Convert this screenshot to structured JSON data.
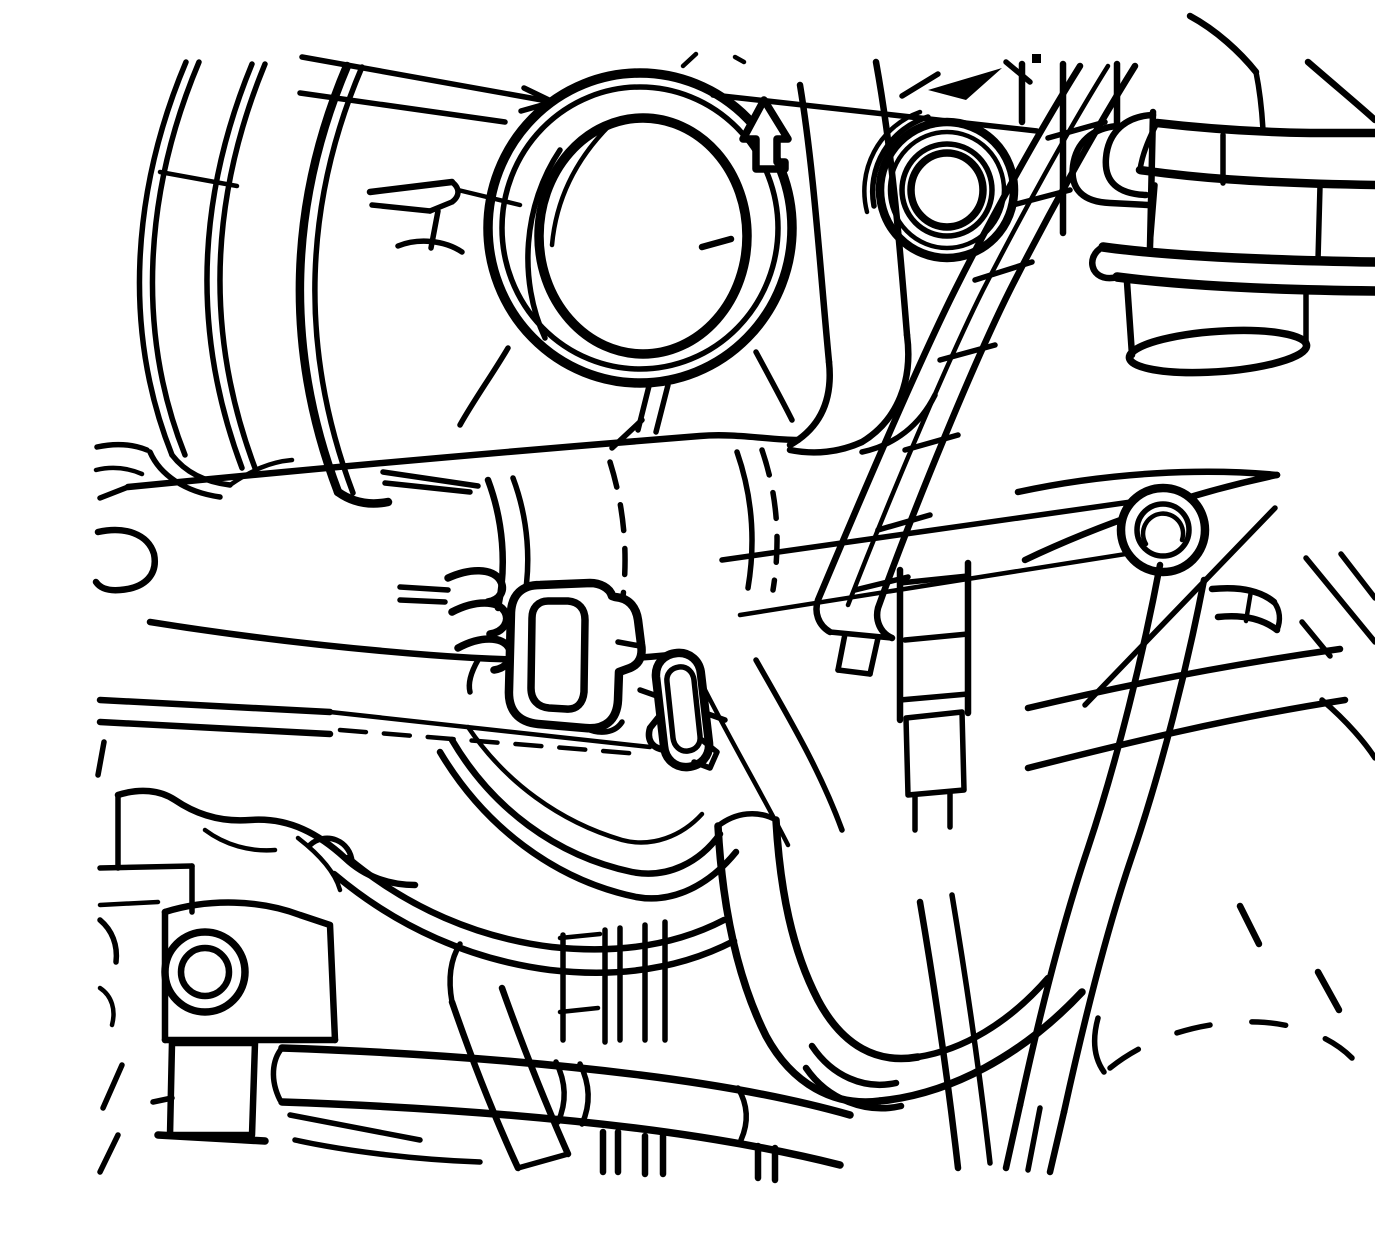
{
  "meta": {
    "title": "Engine compartment line illustration",
    "description": "Black-and-white service-manual line drawing of an engine viewed from the front-lower side, showing the air intake duct opening, hoses, wiring harness conduit and an electrical connector, with an upward-pointing arrow indicator beside the intake opening.",
    "background_color": "#ffffff",
    "ink_color": "#000000"
  },
  "indicator": {
    "icon": "up-arrow-icon",
    "direction": "up"
  },
  "components": [
    {
      "id": "ribbed-disc",
      "label": "ribbed circular housing rim (top left)"
    },
    {
      "id": "intake-ring",
      "label": "air intake duct opening (large double ring)"
    },
    {
      "id": "up-arrow",
      "label": "upward arrow indicator"
    },
    {
      "id": "ribbed-port",
      "label": "small ribbed circular port (top right)"
    },
    {
      "id": "harness-conduit",
      "label": "corrugated wiring harness conduit (diagonal)"
    },
    {
      "id": "heater-fittings",
      "label": "stacked hose fittings and open cylinder (right edge)"
    },
    {
      "id": "manifold-tube",
      "label": "horizontal manifold tube with ring joints"
    },
    {
      "id": "fuel-line",
      "label": "thin double fuel line with hidden-edge dashes"
    },
    {
      "id": "electrical-connector",
      "label": "electrical connector with three wire loops"
    },
    {
      "id": "oval-bracket",
      "label": "obround bracket next to connector"
    },
    {
      "id": "bolt-head",
      "label": "round bolt head on pointed bracket"
    },
    {
      "id": "hose-bundle",
      "label": "curved hose bundle below connector"
    },
    {
      "id": "j-hose",
      "label": "thick J-shaped hose with ribbed bend (bottom center)"
    },
    {
      "id": "bottom-pipe",
      "label": "horizontal pipe with fins (bottom)"
    },
    {
      "id": "engine-boss",
      "label": "engine block boss with bolt hole (bottom left)"
    },
    {
      "id": "fork-tube",
      "label": "forked diagonal tube (bottom right)"
    },
    {
      "id": "hidden-edges",
      "label": "dashed hidden-edge marks (right)"
    }
  ]
}
